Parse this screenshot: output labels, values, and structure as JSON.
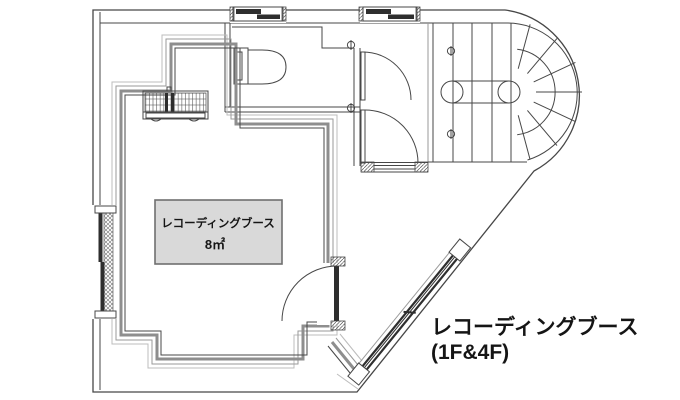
{
  "floor_plan": {
    "room_label": {
      "line1": "レコーディングブース",
      "line2": "8㎡"
    },
    "caption": {
      "line1": "レコーディングブース",
      "line2": "(1F&4F)"
    },
    "colors": {
      "line-dark": "#474747",
      "line-mid": "#9a9a9a",
      "line-light": "#bcbcbc",
      "wall-thick": "#8e8e8e",
      "label-box-fill": "#d9d9d9",
      "label-box-border": "#6f6f6f",
      "sash-dark": "#2e2e2e",
      "text": "#151515"
    }
  }
}
